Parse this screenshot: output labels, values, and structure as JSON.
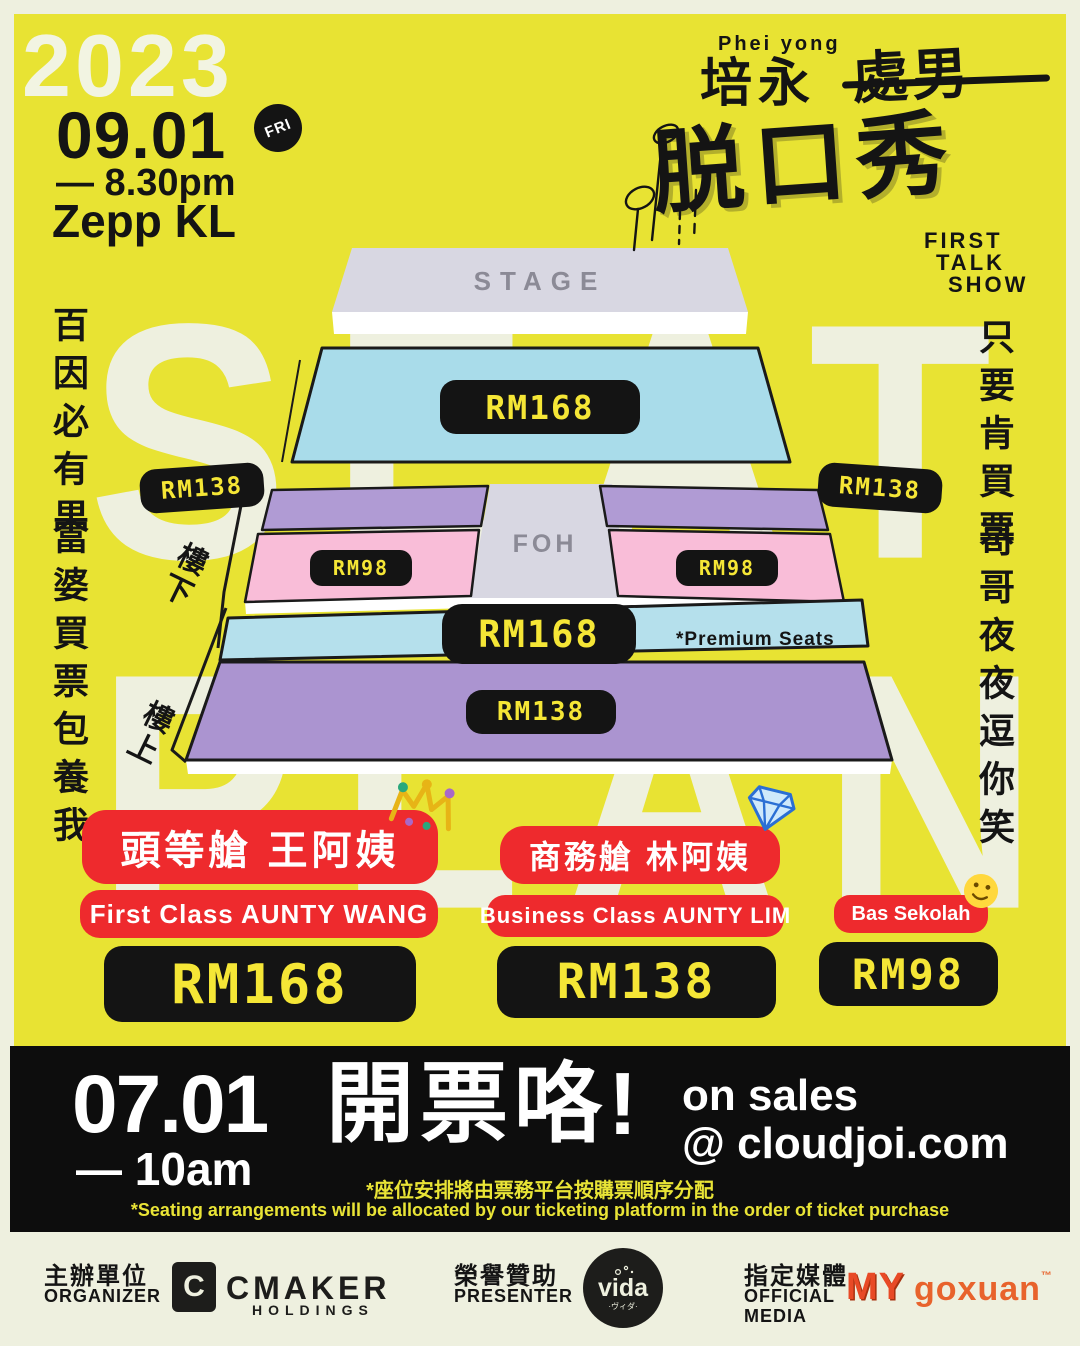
{
  "poster": {
    "year": "2023",
    "date": "09.01",
    "day": "FRI",
    "time": "— 8.30pm",
    "venue": "Zepp KL",
    "bg_word_top": "SEAT",
    "bg_word_bottom": "PLAN"
  },
  "title": {
    "artist_en": "Phei yong",
    "artist_zh": "培永",
    "struck_zh": "處男",
    "main_zh": "脱口秀",
    "sub_line1": "FIRST",
    "sub_line2": "TALK",
    "sub_line3": "SHOW"
  },
  "slogans": {
    "left_1": "百因必有果",
    "left_2": "富婆買票包養我",
    "right_1": "只要肯買票",
    "right_2": "哥哥夜夜逗你笑"
  },
  "seatmap": {
    "stage_label": "STAGE",
    "foh_label": "FOH",
    "downstairs_label": "樓下",
    "upstairs_label": "樓上",
    "premium_note": "*Premium Seats",
    "prices": {
      "main_floor": "RM168",
      "side_left": "RM138",
      "side_right": "RM138",
      "lower_left": "RM98",
      "lower_right": "RM98",
      "premium": "RM168",
      "upstairs": "RM138"
    }
  },
  "tiers": [
    {
      "name_zh": "頭等艙 王阿姨",
      "name_en": "First Class AUNTY WANG",
      "price": "RM168",
      "icon": "crown-icon"
    },
    {
      "name_zh": "商務艙 林阿姨",
      "name_en": "Business Class AUNTY LIM",
      "price": "RM138",
      "icon": "diamond-icon"
    },
    {
      "name_en": "Bas Sekolah",
      "price": "RM98",
      "icon": "smiley-icon"
    }
  ],
  "sales": {
    "date": "07.01",
    "time": "— 10am",
    "headline_zh": "開票咯!",
    "line1": "on sales",
    "line2": "@ cloudjoi.com",
    "note_zh": "*座位安排將由票務平台按購票順序分配",
    "note_en": "*Seating arrangements will be allocated by our ticketing platform in the order of ticket purchase"
  },
  "footer": {
    "organizer_zh": "主辦單位",
    "organizer_en": "ORGANIZER",
    "organizer_mark": "C",
    "organizer_name": "CMAKER",
    "organizer_sub": "HOLDINGS",
    "presenter_zh": "榮譽贊助",
    "presenter_en": "PRESENTER",
    "presenter_logo": "vida",
    "presenter_logo_sub": "·ヴィダ·",
    "media_zh": "指定媒體",
    "media_en_1": "OFFICIAL",
    "media_en_2": "MEDIA",
    "media_logo_1": "MY",
    "media_logo_2": "goxuan",
    "media_logo_2_tm": "™"
  },
  "colors": {
    "yellow": "#e8e333",
    "cream": "#eef0df",
    "red": "#ee2a2d",
    "black": "#141414",
    "blue": "#a9dcea",
    "purple": "#b09bd4",
    "pink": "#f9bdd8",
    "stage_gray": "#d8d7e2",
    "price_yellow": "#f5e636",
    "orange": "#e8632c"
  }
}
